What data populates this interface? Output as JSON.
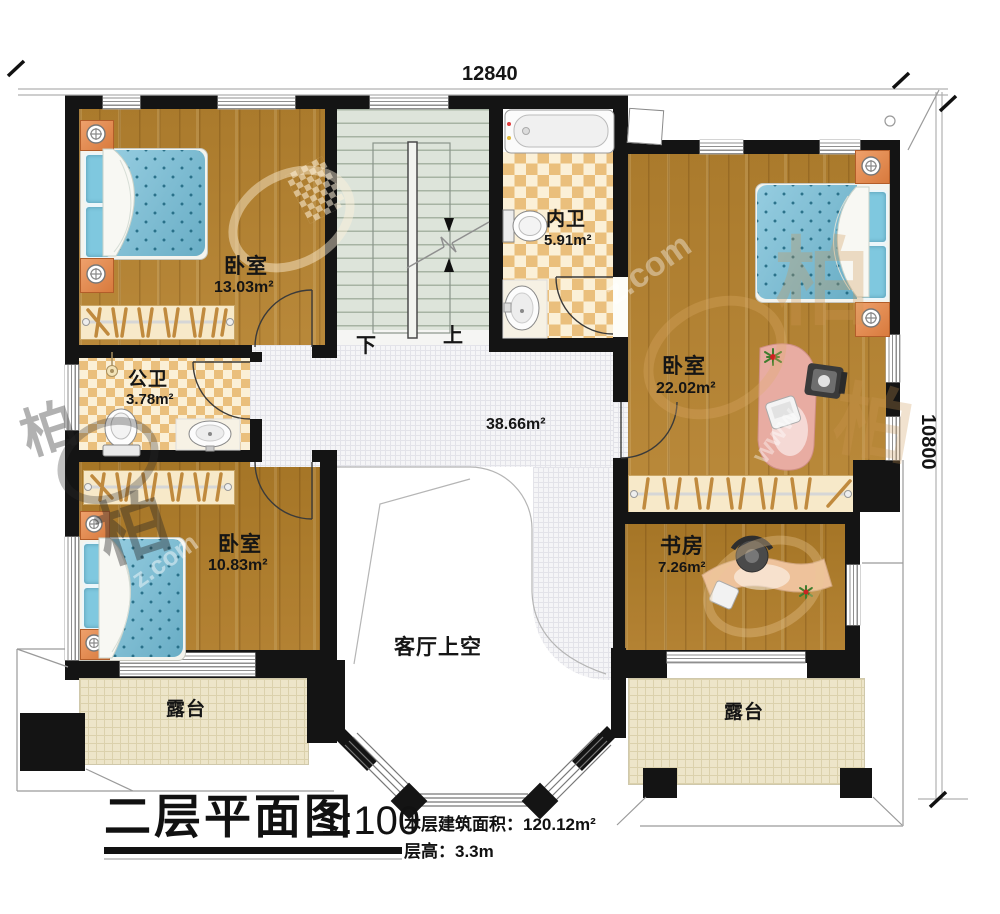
{
  "title_block": {
    "title": "二层平面图",
    "scale": "1:100",
    "area_text": "本层建筑面积：120.12m²",
    "floor_height_text": "层高：3.3m"
  },
  "dimensions": {
    "width_mm": "12840",
    "height_mm": "10800"
  },
  "stairs": {
    "down_label": "下",
    "up_label": "上"
  },
  "rooms": {
    "bedroom_top_left": {
      "name": "卧室",
      "area": "13.03m²"
    },
    "bath_inner": {
      "name": "内卫",
      "area": "5.91m²"
    },
    "bedroom_top_right": {
      "name": "卧室",
      "area": "22.02m²"
    },
    "bath_public": {
      "name": "公卫",
      "area": "3.78m²"
    },
    "bedroom_bottom_left": {
      "name": "卧室",
      "area": "10.83m²"
    },
    "study": {
      "name": "书房",
      "area": "7.26m²"
    },
    "hall": {
      "area": "38.66m²"
    },
    "living_void": {
      "name": "客厅上空"
    },
    "terrace_left": {
      "name": "露台"
    },
    "terrace_right": {
      "name": "露台"
    }
  },
  "watermark": {
    "www_fragment": "www",
    "domain_fragment": "z.com",
    "logo_glyph": "柏"
  },
  "colors": {
    "wall": "#141414",
    "wood": "#b5822f",
    "mattress": "#72bcd6",
    "stair": "#dde4da",
    "hall_tile": "#f5f5f7",
    "terrace": "#ede5c9",
    "checker_dark": "#eabf7c",
    "checker_light": "#fbf0d7",
    "nightstand_orange": "#e0854f",
    "desk_pink": "#e8aca2"
  }
}
